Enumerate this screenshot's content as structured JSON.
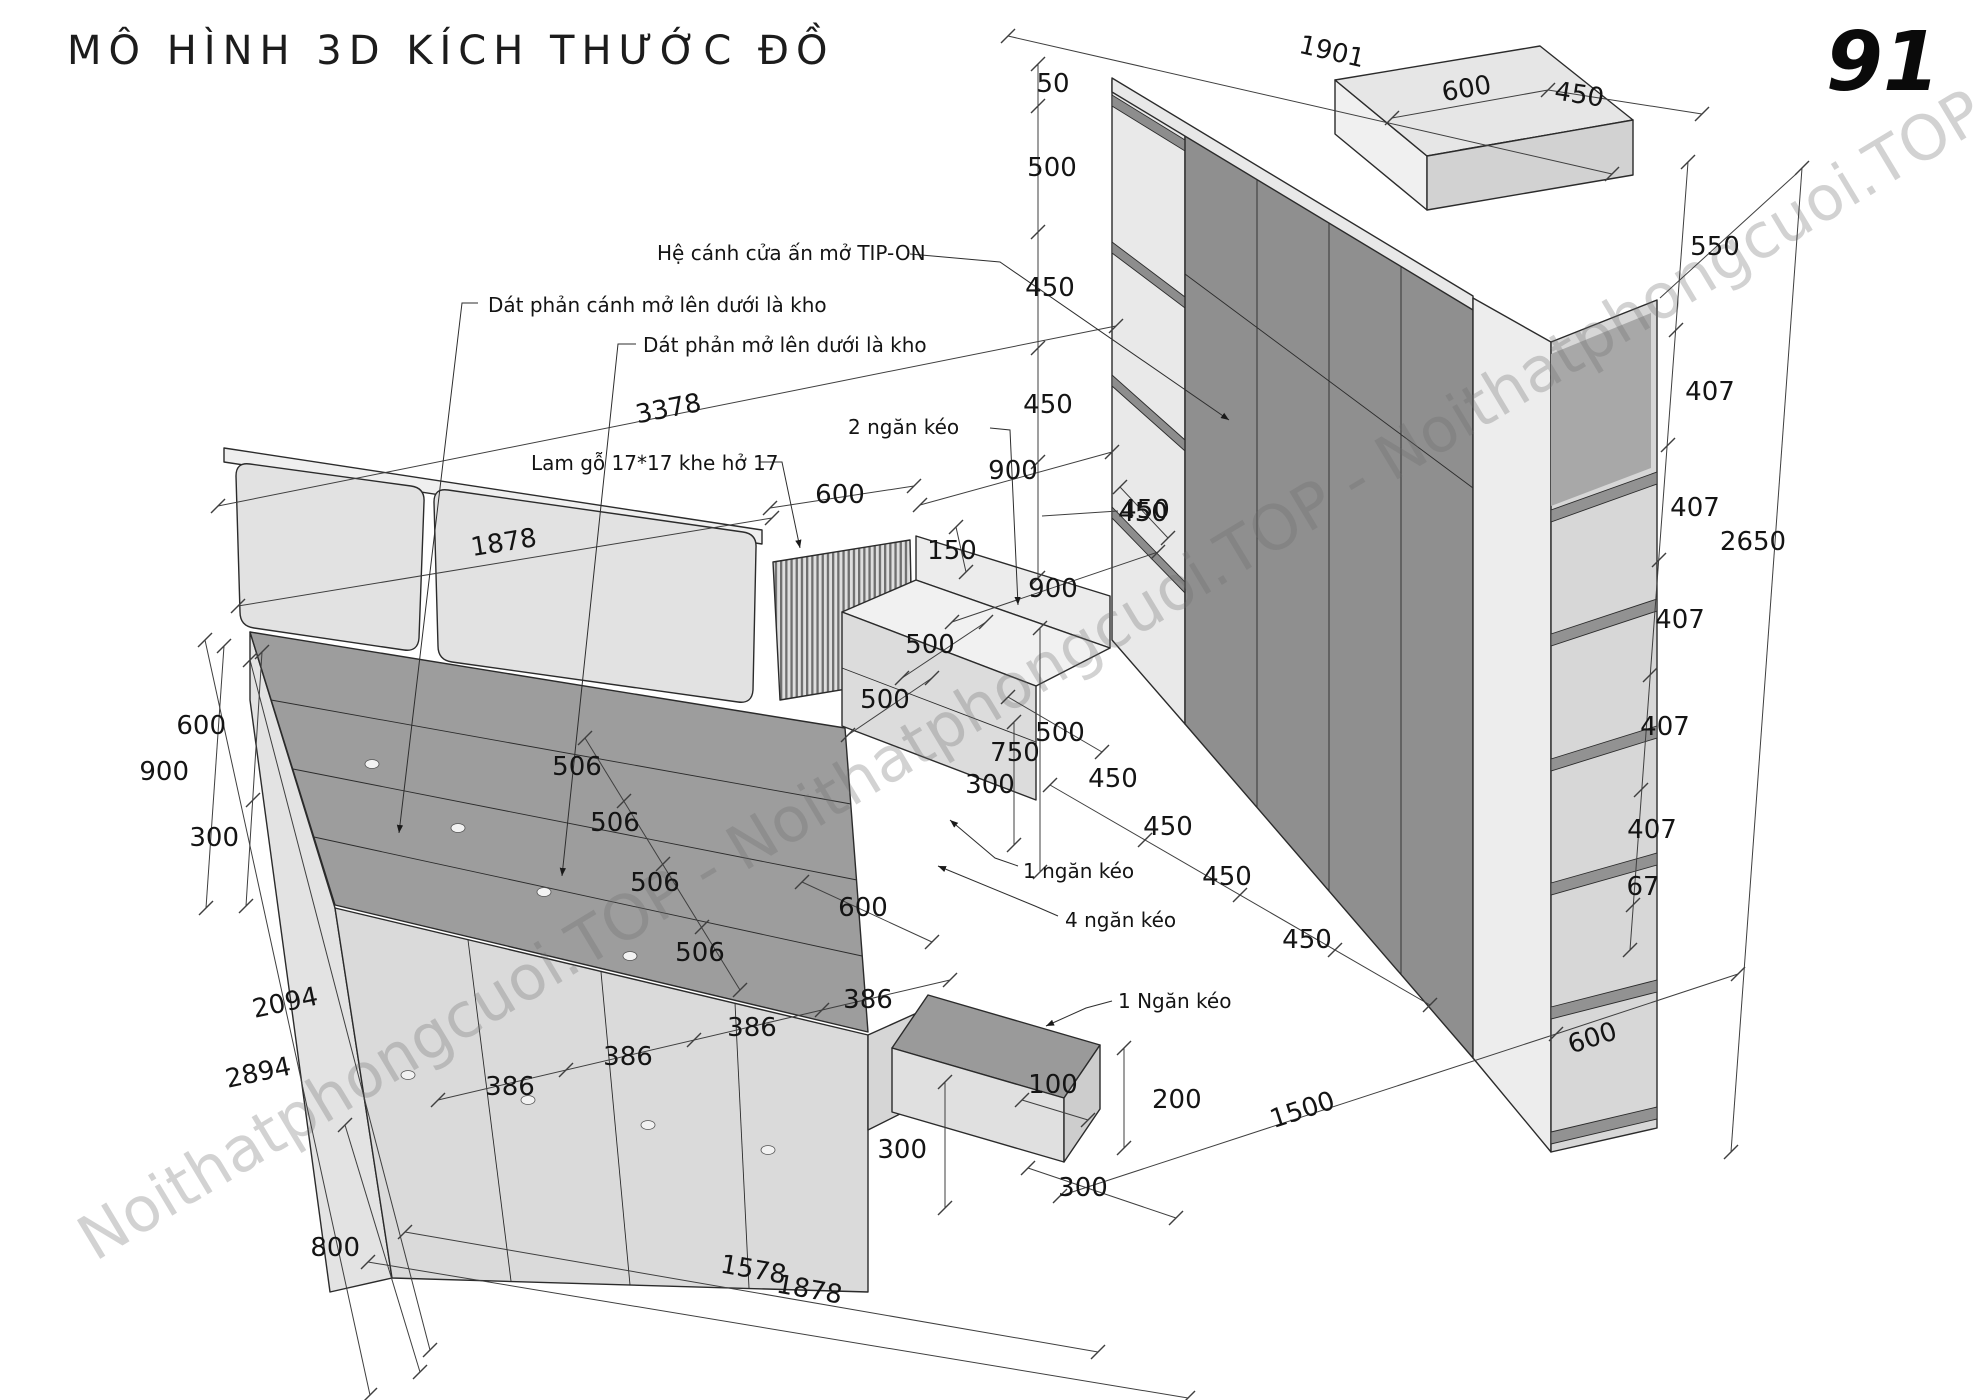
{
  "title": "MÔ HÌNH 3D KÍCH THƯỚC ĐỒ",
  "page_number": "91",
  "watermark": "Noithatphongcuoi.TOP - Noithatphongcuoi.TOP - Noithatphongcuoi.TOP",
  "annotations": {
    "tip_on": "Hệ cánh cửa ấn mở TIP-ON",
    "panel_door_storage": "Dát phản cánh mở lên dưới là kho",
    "panel_storage": "Dát phản mở lên dưới là kho",
    "slat": "Lam gỗ 17*17 khe hở 17",
    "two_drawer": "2 ngăn kéo",
    "one_drawer": "1 ngăn kéo",
    "four_drawer": "4 ngăn kéo",
    "one_drawer2": "1 Ngăn kéo"
  },
  "dims": {
    "top": {
      "h50": "50",
      "w1901": "1901",
      "d600": "600",
      "d450": "450"
    },
    "left_col": [
      "500",
      "450",
      "450",
      "450"
    ],
    "right_col": {
      "top": "550",
      "shelf": [
        "407",
        "407",
        "407",
        "407",
        "407"
      ],
      "base": "67",
      "total": "2650"
    },
    "mid": {
      "alcove": "900",
      "ret450": "450",
      "desk": "900",
      "back": "150",
      "slat": "600",
      "dep1": "500",
      "dep2": "500",
      "h750": "750",
      "h300": "300",
      "base": "500"
    },
    "doors": [
      "450",
      "450",
      "450",
      "450"
    ],
    "floor": {
      "w1500": "1500",
      "d600": "600"
    },
    "bed": {
      "hb": "1878",
      "total": "3378",
      "e600": "600",
      "e900": "900",
      "e300": "300",
      "l1": "2094",
      "l2": "2894",
      "h800": "800",
      "p": [
        "506",
        "506",
        "506",
        "506"
      ],
      "foot": "600",
      "dr": [
        "386",
        "386",
        "386",
        "386"
      ],
      "f300": "300",
      "s100": "100",
      "s200": "200",
      "s300": "300",
      "b1578": "1578",
      "b1878": "1878"
    }
  }
}
